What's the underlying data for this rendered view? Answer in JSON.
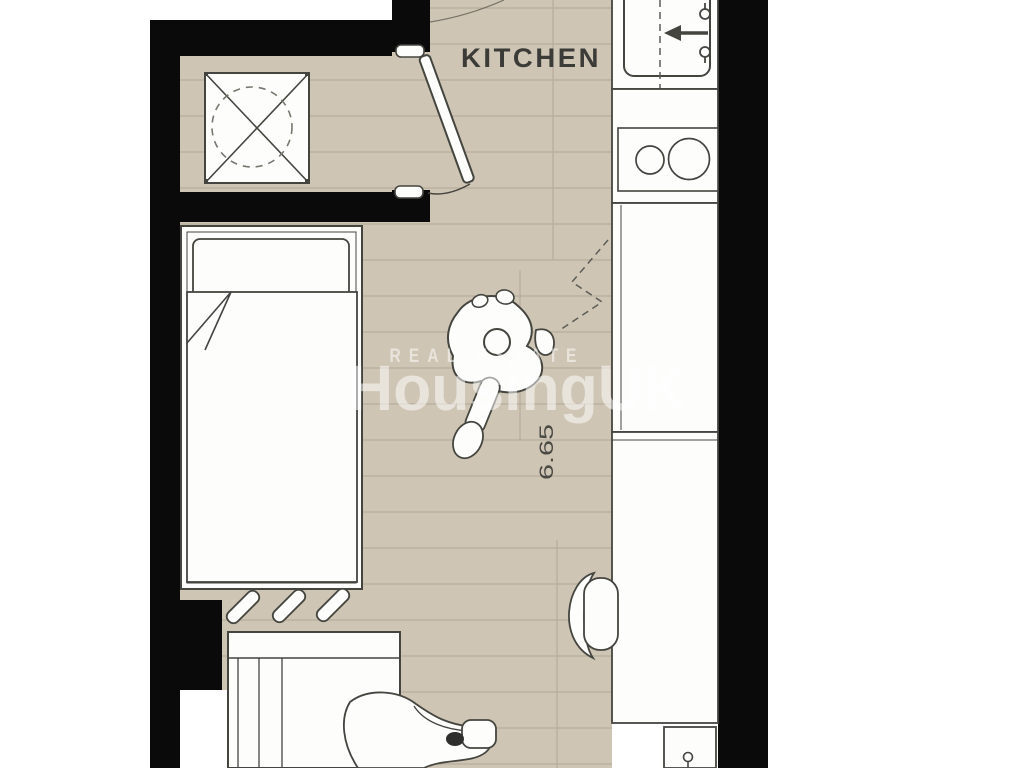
{
  "plan": {
    "room_label": "KITCHEN",
    "dimension_label": "6.65",
    "watermark": {
      "line1": "REAL ESTATE",
      "line2": "HousingUK"
    },
    "colors": {
      "wall": "#0a0a0a",
      "floor": "#cfc5b4",
      "plank_line": "#b8ad9c",
      "outline": "#45453f",
      "label_text": "#3b3b38",
      "dimension_text": "#4a4a45",
      "watermark_text": "rgba(255,255,255,0.52)"
    },
    "fixtures": [
      "shower-tray",
      "entry-door",
      "kitchen-sink",
      "faucet",
      "hob",
      "kitchen-counter",
      "tall-unit",
      "bed",
      "pillow",
      "duvet",
      "radiator-hatching",
      "wardrobe",
      "desk-chair",
      "person-seated",
      "person-lounging"
    ]
  }
}
